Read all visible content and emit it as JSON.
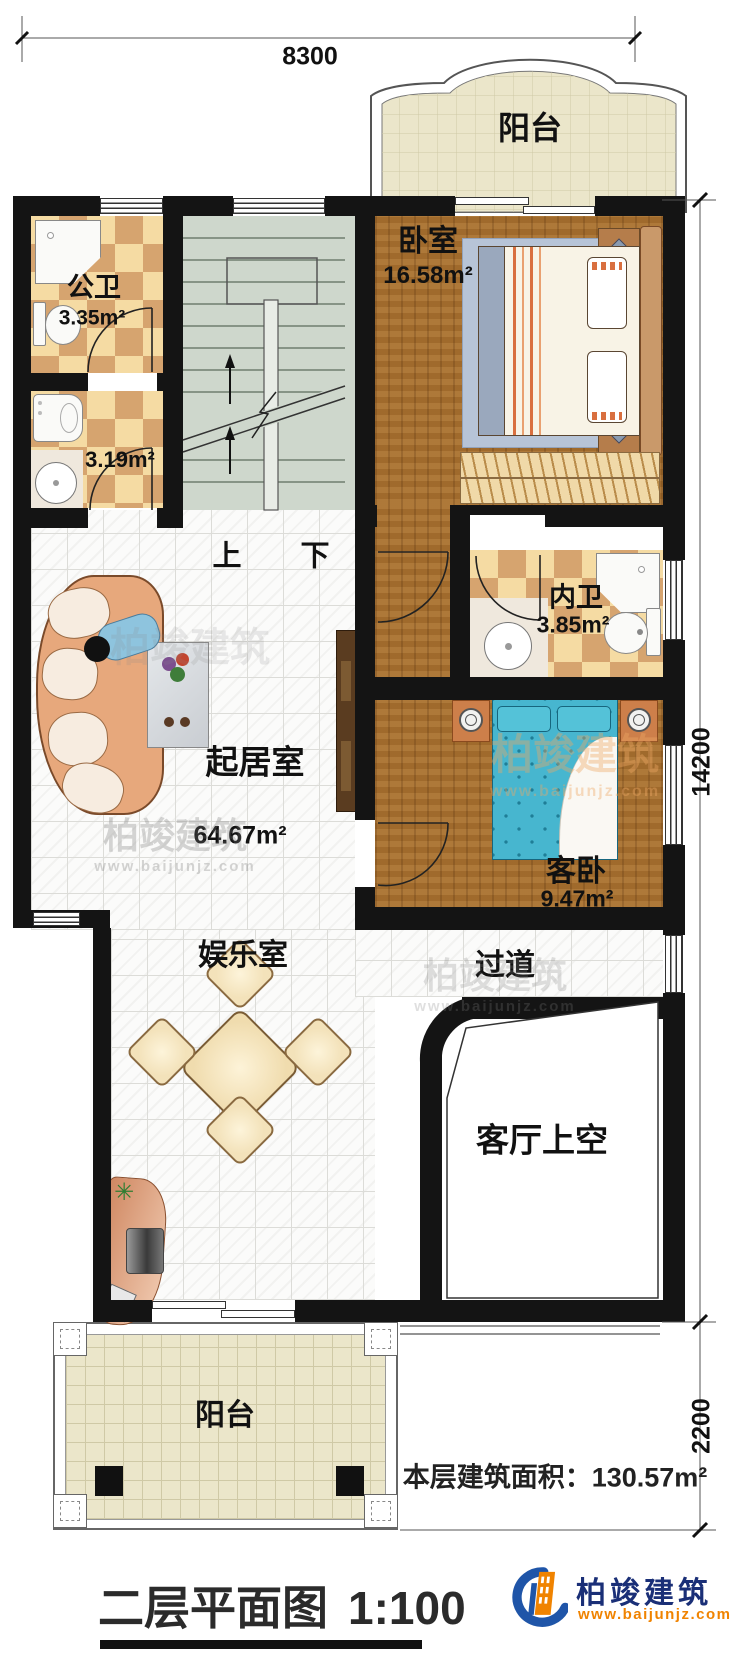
{
  "title_block": {
    "title": "二层平面图",
    "scale": "1:100"
  },
  "area_summary": {
    "label": "本层建筑面积：",
    "value": "130.57m²"
  },
  "dimensions": {
    "top": "8300",
    "right_upper": "14200",
    "right_lower": "2200"
  },
  "rooms": {
    "balcony_top": {
      "name": "阳台"
    },
    "public_bath": {
      "name": "公卫",
      "area": "3.35m²"
    },
    "utility": {
      "area": "3.19m²"
    },
    "bedroom": {
      "name": "卧室",
      "area": "16.58m²"
    },
    "inner_bath": {
      "name": "内卫",
      "area": "3.85m²"
    },
    "living_room": {
      "name": "起居室",
      "area": "64.67m²"
    },
    "guest_bedroom": {
      "name": "客卧",
      "area": "9.47m²"
    },
    "entertainment": {
      "name": "娱乐室"
    },
    "corridor": {
      "name": "过道"
    },
    "living_void": {
      "name": "客厅上空"
    },
    "balcony_bottom": {
      "name": "阳台"
    }
  },
  "stairs": {
    "up": "上",
    "down": "下"
  },
  "branding": {
    "logo_name": "柏竣建筑",
    "logo_url": "www.baijunjz.com"
  },
  "watermark": {
    "text": "柏竣建筑",
    "url": "www.baijunjz.com"
  },
  "colors": {
    "wall": "#141414",
    "wood": "#a8702e",
    "tile_light": "#f5dba3",
    "tile_dark": "#d6a46f",
    "logo_blue": "#1f55a8",
    "logo_orange": "#f08300",
    "guest_bed": "#47b6cf"
  }
}
